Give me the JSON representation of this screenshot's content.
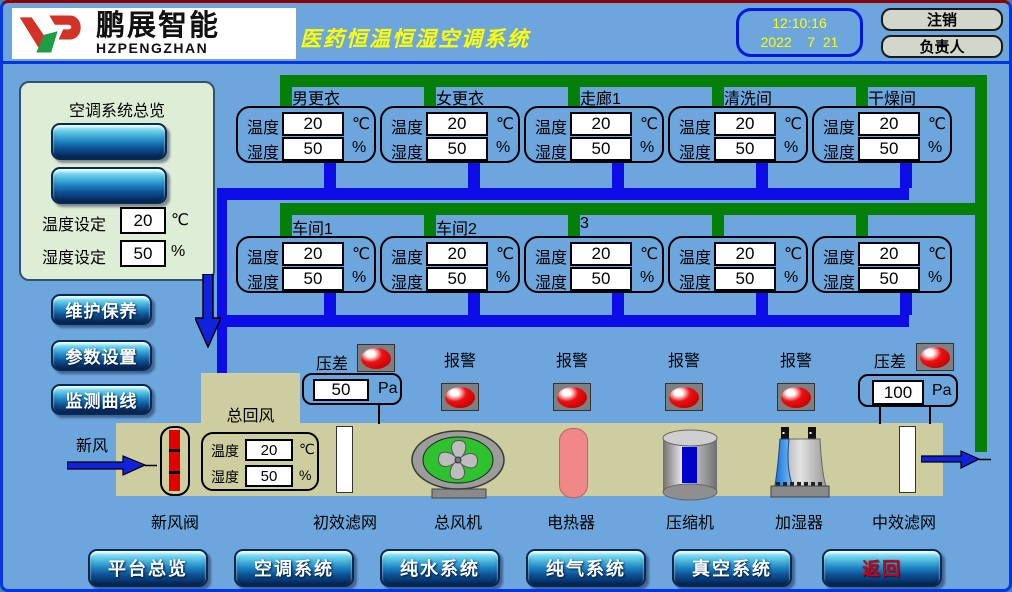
{
  "header": {
    "logo": {
      "company_cn": "鹏展智能",
      "company_en": "HZPENGZHAN"
    },
    "title": "医药恒温恒湿空调系统",
    "clock": {
      "time": "12:10:16",
      "date": "2022    7  21"
    },
    "logout_label": "注销",
    "role_label": "负责人"
  },
  "sidebar": {
    "overview_title": "空调系统总览",
    "temp_set": {
      "label": "温度设定",
      "value": "20",
      "unit": "℃"
    },
    "humi_set": {
      "label": "湿度设定",
      "value": "50",
      "unit": "%"
    },
    "menu": [
      {
        "label": "维护保养"
      },
      {
        "label": "参数设置"
      },
      {
        "label": "监测曲线"
      }
    ]
  },
  "rooms": {
    "temp_label": "温度",
    "humi_label": "湿度",
    "temp_unit": "℃",
    "humi_unit": "%",
    "row1": [
      {
        "name": "男更衣",
        "temp": "20",
        "humi": "50"
      },
      {
        "name": "女更衣",
        "temp": "20",
        "humi": "50"
      },
      {
        "name": "走廊1",
        "temp": "20",
        "humi": "50"
      },
      {
        "name": "清洗间",
        "temp": "20",
        "humi": "50"
      },
      {
        "name": "干燥间",
        "temp": "20",
        "humi": "50"
      }
    ],
    "row2": [
      {
        "name": "车间1",
        "temp": "20",
        "humi": "50"
      },
      {
        "name": "车间2",
        "temp": "20",
        "humi": "50"
      },
      {
        "name": "3",
        "temp": "20",
        "humi": "50"
      },
      {
        "name": "",
        "temp": "20",
        "humi": "50"
      },
      {
        "name": "",
        "temp": "20",
        "humi": "50"
      }
    ]
  },
  "ahu": {
    "fresh_air_label": "新风",
    "return_air_label": "总回风",
    "duct_temp": {
      "label": "温度",
      "value": "20",
      "unit": "℃"
    },
    "duct_humi": {
      "label": "湿度",
      "value": "50",
      "unit": "%"
    },
    "alarm_label": "报警",
    "pressure_left": {
      "label": "压差",
      "value": "50",
      "unit": "Pa"
    },
    "pressure_right": {
      "label": "压差",
      "value": "100",
      "unit": "Pa"
    },
    "components": [
      {
        "name": "新风阀"
      },
      {
        "name": "初效滤网"
      },
      {
        "name": "总风机"
      },
      {
        "name": "电热器"
      },
      {
        "name": "压缩机"
      },
      {
        "name": "加湿器"
      },
      {
        "name": "中效滤网"
      }
    ]
  },
  "nav": [
    {
      "label": "平台总览"
    },
    {
      "label": "空调系统"
    },
    {
      "label": "纯水系统"
    },
    {
      "label": "纯气系统"
    },
    {
      "label": "真空系统"
    },
    {
      "label": "返回",
      "accent": "red"
    }
  ],
  "colors": {
    "background": "#6CA6DC",
    "supply_pipe_green": "#067F06",
    "return_pipe_blue": "#0D0DE8",
    "duct_beige": "#CDCDA0",
    "sidebar_green": "#DEEDD6",
    "title_yellow": "#FFFF00",
    "alarm_red": "#DD0000",
    "heater_pink": "#F08888",
    "nav_return_red": "#CC0011"
  }
}
